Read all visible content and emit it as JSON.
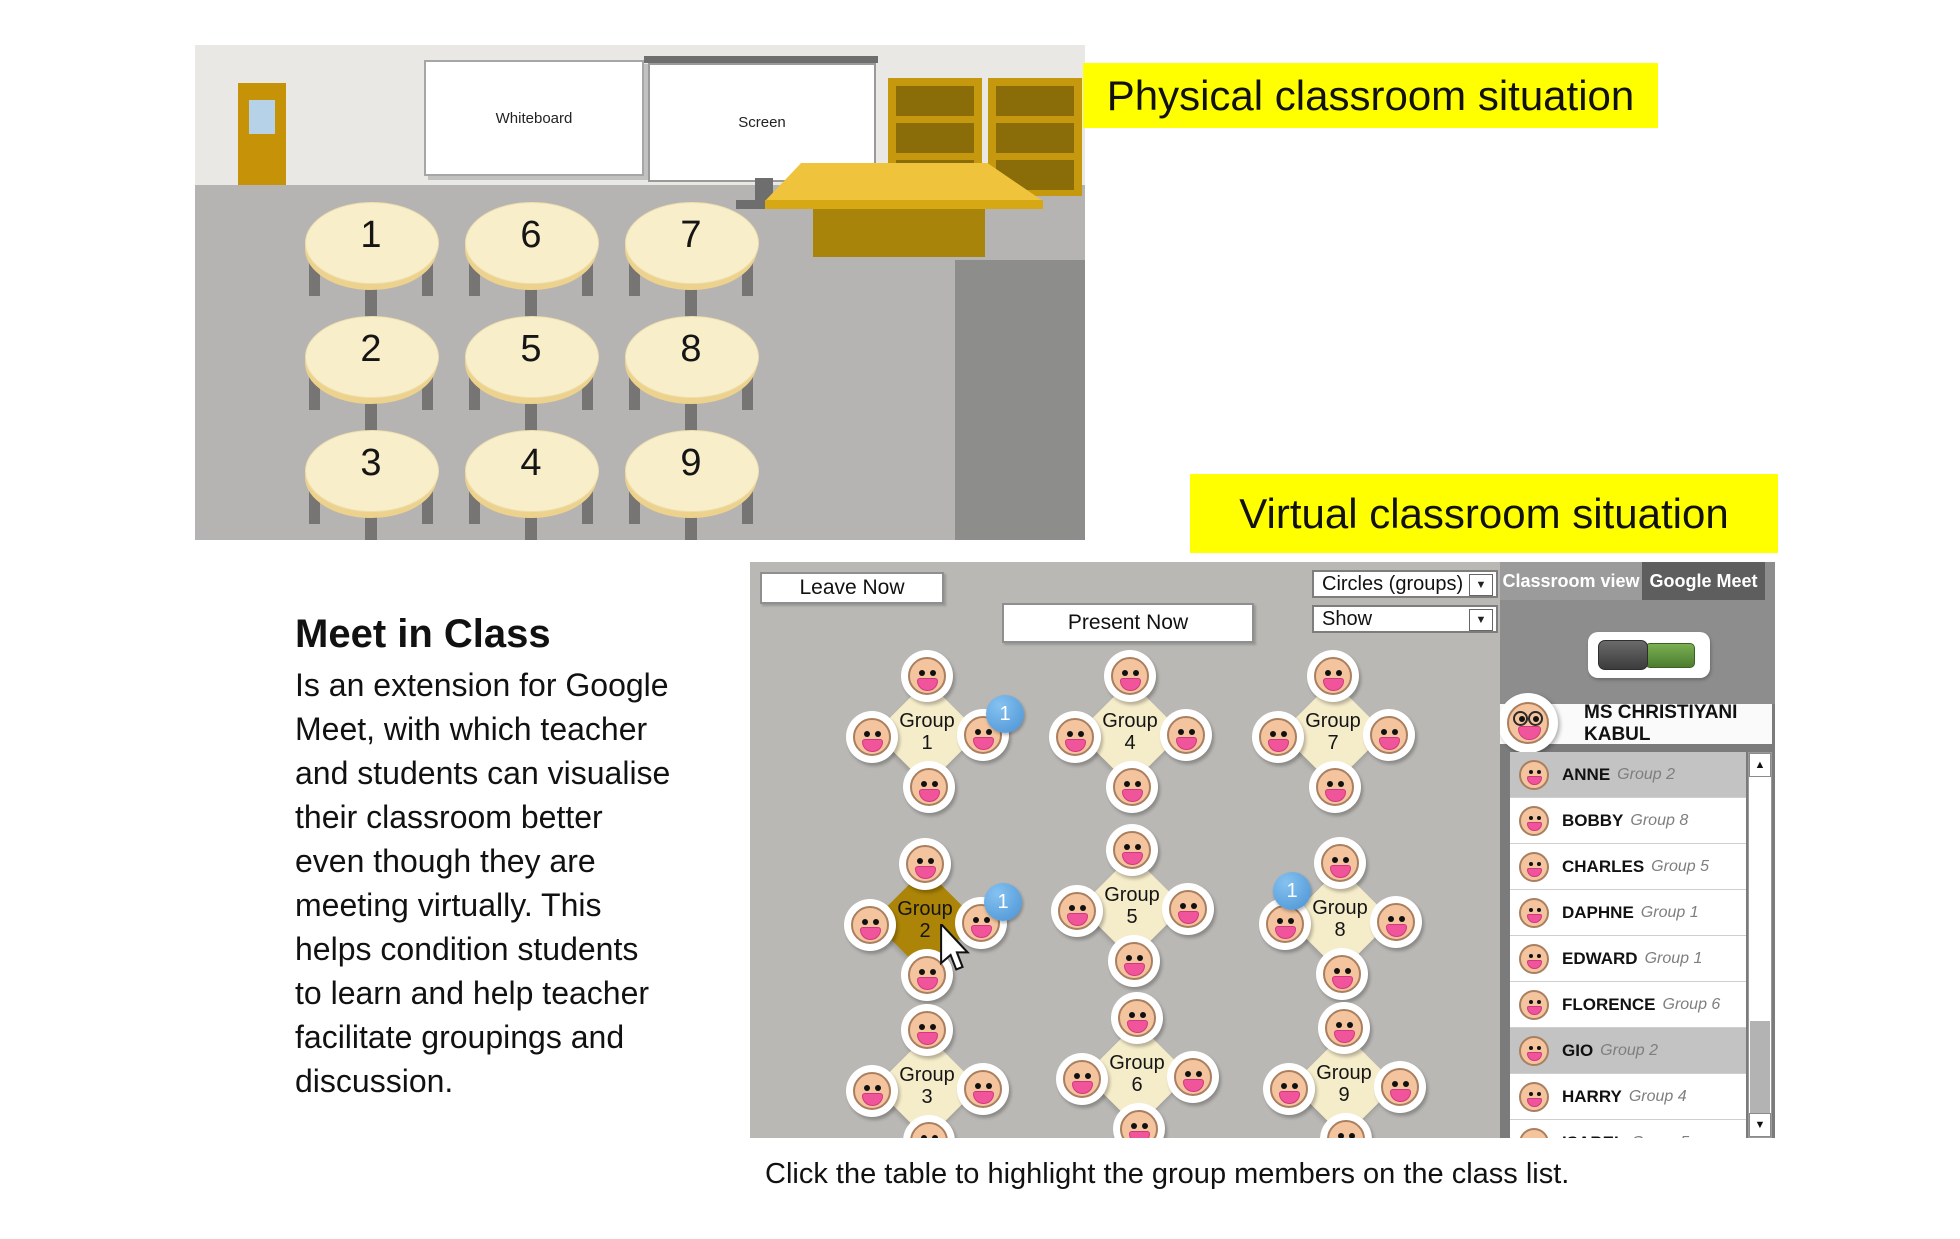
{
  "labels": {
    "physical": "Physical classroom situation",
    "virtual": "Virtual classroom situation"
  },
  "classroom": {
    "whiteboard_label": "Whiteboard",
    "screen_label": "Screen",
    "table_rows": [
      [
        "1",
        "6",
        "7"
      ],
      [
        "2",
        "5",
        "8"
      ],
      [
        "3",
        "4",
        "9"
      ]
    ]
  },
  "description": {
    "title": "Meet in Class",
    "lines": [
      "Is an extension for Google",
      "Meet, with which teacher",
      "and students can visualise",
      "their classroom better",
      "even though they are",
      "meeting virtually. This",
      "helps condition students",
      "to learn and help teacher",
      "facilitate groupings and",
      "discussion."
    ]
  },
  "virtual_ui": {
    "leave_label": "Leave Now",
    "present_label": "Present Now",
    "view_dropdown_value": "Circles (groups)",
    "show_dropdown_value": "Show",
    "tabs": [
      {
        "label": "Classroom view"
      },
      {
        "label": "Google Meet"
      }
    ],
    "teacher_name": "MS CHRISTIYANI KABUL",
    "group_word": "Group",
    "badge_label": "1",
    "groups": [
      {
        "number": "1",
        "selected": false,
        "badge": "right"
      },
      {
        "number": "4",
        "selected": false,
        "badge": null
      },
      {
        "number": "7",
        "selected": false,
        "badge": null
      },
      {
        "number": "2",
        "selected": true,
        "badge": "right"
      },
      {
        "number": "5",
        "selected": false,
        "badge": null
      },
      {
        "number": "8",
        "selected": false,
        "badge": "left"
      },
      {
        "number": "3",
        "selected": false,
        "badge": null
      },
      {
        "number": "6",
        "selected": false,
        "badge": null
      },
      {
        "number": "9",
        "selected": false,
        "badge": null
      }
    ],
    "students": [
      {
        "name": "ANNE",
        "group": "Group 2",
        "highlighted": true
      },
      {
        "name": "BOBBY",
        "group": "Group 8",
        "highlighted": false
      },
      {
        "name": "CHARLES",
        "group": "Group 5",
        "highlighted": false
      },
      {
        "name": "DAPHNE",
        "group": "Group 1",
        "highlighted": false
      },
      {
        "name": "EDWARD",
        "group": "Group 1",
        "highlighted": false
      },
      {
        "name": "FLORENCE",
        "group": "Group 6",
        "highlighted": false
      },
      {
        "name": "GIO",
        "group": "Group 2",
        "highlighted": true
      },
      {
        "name": "HARRY",
        "group": "Group 4",
        "highlighted": false
      },
      {
        "name": "ISABEL",
        "group": "Group 5",
        "highlighted": false
      }
    ],
    "colors": {
      "group_normal": "#f5ecca",
      "group_selected": "#ac8407",
      "badge_blue": "#4a92d4",
      "highlight_yellow": "#ffff00"
    }
  },
  "caption": "Click the table to highlight the group members on the class list."
}
